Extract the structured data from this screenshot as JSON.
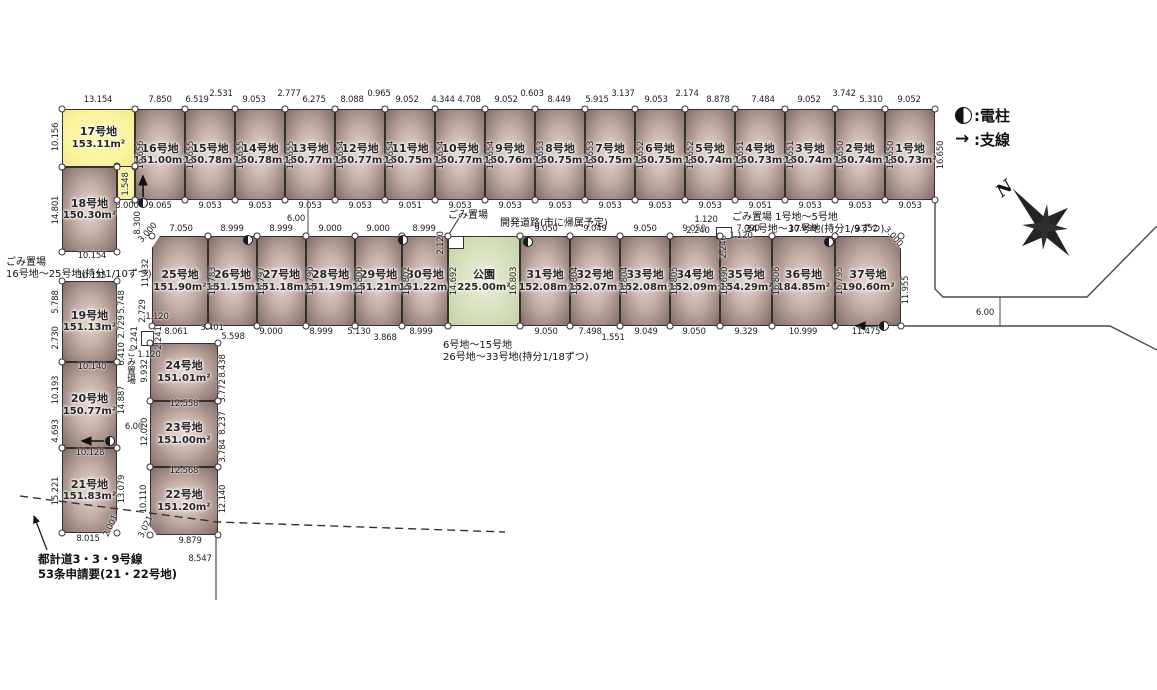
{
  "legend": {
    "pole": ":電柱",
    "wire": ":支線"
  },
  "compass": {
    "north": "N"
  },
  "notes": {
    "garbage_left_1": "ごみ置場",
    "garbage_left_2": "16号地～25号地(持分1/10ずつ)",
    "dev_road": "開発道路(市に帰属予定)",
    "garbage_park": "ごみ置場",
    "garbage_right_1": "ごみ置場  1号地～5号地",
    "garbage_right_2": "34号地～37号地(持分1/9ずつ)",
    "garbage_mid_1": "6号地～15号地",
    "garbage_mid_2": "26号地～33号地(持分1/18ずつ)",
    "garbage_col": "ごみ置場",
    "plan_road_1": "都計道3・3・9号線",
    "plan_road_2": "53条申請要(21・22号地)"
  },
  "lots": [
    {
      "id": "17",
      "name": "17号地",
      "area": "153.11m²",
      "x": 62,
      "y": 109,
      "w": 73,
      "h": 58,
      "type": "highlight"
    },
    {
      "id": "17-strip",
      "x": 117,
      "y": 166,
      "w": 18,
      "h": 34,
      "type": "highlight"
    },
    {
      "id": "16",
      "name": "16号地",
      "area": "151.00m²",
      "x": 135,
      "y": 109,
      "w": 50,
      "h": 91
    },
    {
      "id": "15",
      "name": "15号地",
      "area": "150.78m²",
      "x": 185,
      "y": 109,
      "w": 50,
      "h": 91
    },
    {
      "id": "14",
      "name": "14号地",
      "area": "150.78m²",
      "x": 235,
      "y": 109,
      "w": 50,
      "h": 91
    },
    {
      "id": "13",
      "name": "13号地",
      "area": "150.77m²",
      "x": 285,
      "y": 109,
      "w": 50,
      "h": 91
    },
    {
      "id": "12",
      "name": "12号地",
      "area": "150.77m²",
      "x": 335,
      "y": 109,
      "w": 50,
      "h": 91
    },
    {
      "id": "11",
      "name": "11号地",
      "area": "150.75m²",
      "x": 385,
      "y": 109,
      "w": 50,
      "h": 91
    },
    {
      "id": "10",
      "name": "10号地",
      "area": "150.77m²",
      "x": 435,
      "y": 109,
      "w": 50,
      "h": 91
    },
    {
      "id": "9",
      "name": "9号地",
      "area": "150.76m²",
      "x": 485,
      "y": 109,
      "w": 50,
      "h": 91
    },
    {
      "id": "8",
      "name": "8号地",
      "area": "150.75m²",
      "x": 535,
      "y": 109,
      "w": 50,
      "h": 91
    },
    {
      "id": "7",
      "name": "7号地",
      "area": "150.75m²",
      "x": 585,
      "y": 109,
      "w": 50,
      "h": 91
    },
    {
      "id": "6",
      "name": "6号地",
      "area": "150.75m²",
      "x": 635,
      "y": 109,
      "w": 50,
      "h": 91
    },
    {
      "id": "5",
      "name": "5号地",
      "area": "150.74m²",
      "x": 685,
      "y": 109,
      "w": 50,
      "h": 91
    },
    {
      "id": "4",
      "name": "4号地",
      "area": "150.73m²",
      "x": 735,
      "y": 109,
      "w": 50,
      "h": 91
    },
    {
      "id": "3",
      "name": "3号地",
      "area": "150.74m²",
      "x": 785,
      "y": 109,
      "w": 50,
      "h": 91
    },
    {
      "id": "2",
      "name": "2号地",
      "area": "150.74m²",
      "x": 835,
      "y": 109,
      "w": 50,
      "h": 91
    },
    {
      "id": "1",
      "name": "1号地",
      "area": "150.73m²",
      "x": 885,
      "y": 109,
      "w": 50,
      "h": 91
    },
    {
      "id": "18",
      "name": "18号地",
      "area": "150.30m²",
      "x": 62,
      "y": 167,
      "w": 55,
      "h": 85
    },
    {
      "id": "19",
      "name": "19号地",
      "area": "151.13m²",
      "x": 62,
      "y": 281,
      "w": 55,
      "h": 81
    },
    {
      "id": "20",
      "name": "20号地",
      "area": "150.77m²",
      "x": 62,
      "y": 362,
      "w": 55,
      "h": 86
    },
    {
      "id": "21",
      "name": "21号地",
      "area": "151.83m²",
      "x": 62,
      "y": 448,
      "w": 55,
      "h": 85,
      "clip": "polygon(0 0,100% 0,100% 85%,86% 100%,0 100%)"
    },
    {
      "id": "24",
      "name": "24号地",
      "area": "151.01m²",
      "x": 150,
      "y": 343,
      "w": 68,
      "h": 58
    },
    {
      "id": "23",
      "name": "23号地",
      "area": "151.00m²",
      "x": 150,
      "y": 401,
      "w": 68,
      "h": 66
    },
    {
      "id": "22",
      "name": "22号地",
      "area": "151.20m²",
      "x": 150,
      "y": 467,
      "w": 68,
      "h": 68,
      "clip": "polygon(0 0,100% 0,100% 100%,10% 100%,0 87%)"
    },
    {
      "id": "25",
      "name": "25号地",
      "area": "151.90m²",
      "x": 152,
      "y": 236,
      "w": 56,
      "h": 90,
      "clip": "polygon(14% 0,100% 0,100% 100%,0 100%,0 13%)"
    },
    {
      "id": "26",
      "name": "26号地",
      "area": "151.15m²",
      "x": 208,
      "y": 236,
      "w": 49,
      "h": 90
    },
    {
      "id": "27",
      "name": "27号地",
      "area": "151.18m²",
      "x": 257,
      "y": 236,
      "w": 49,
      "h": 90
    },
    {
      "id": "28",
      "name": "28号地",
      "area": "151.19m²",
      "x": 306,
      "y": 236,
      "w": 49,
      "h": 90
    },
    {
      "id": "29",
      "name": "29号地",
      "area": "151.21m²",
      "x": 355,
      "y": 236,
      "w": 47,
      "h": 90
    },
    {
      "id": "30",
      "name": "30号地",
      "area": "151.22m²",
      "x": 402,
      "y": 236,
      "w": 46,
      "h": 90
    },
    {
      "id": "park",
      "name": "公園",
      "area": "225.00m²",
      "x": 448,
      "y": 236,
      "w": 72,
      "h": 90,
      "type": "park"
    },
    {
      "id": "31",
      "name": "31号地",
      "area": "152.08m²",
      "x": 520,
      "y": 236,
      "w": 50,
      "h": 90
    },
    {
      "id": "32",
      "name": "32号地",
      "area": "152.07m²",
      "x": 570,
      "y": 236,
      "w": 50,
      "h": 90
    },
    {
      "id": "33",
      "name": "33号地",
      "area": "152.08m²",
      "x": 620,
      "y": 236,
      "w": 50,
      "h": 90
    },
    {
      "id": "34",
      "name": "34号地",
      "area": "152.09m²",
      "x": 670,
      "y": 236,
      "w": 50,
      "h": 90
    },
    {
      "id": "35",
      "name": "35号地",
      "area": "154.29m²",
      "x": 720,
      "y": 236,
      "w": 52,
      "h": 90
    },
    {
      "id": "36",
      "name": "36号地",
      "area": "184.85m²",
      "x": 772,
      "y": 236,
      "w": 63,
      "h": 90
    },
    {
      "id": "37",
      "name": "37号地",
      "area": "190.60m²",
      "x": 835,
      "y": 236,
      "w": 66,
      "h": 90,
      "clip": "polygon(0 0,86% 0,100% 14%,100% 100%,0 100%)"
    }
  ],
  "boxes": [
    {
      "x": 448,
      "y": 236,
      "w": 16,
      "h": 13
    },
    {
      "x": 716,
      "y": 227,
      "w": 16,
      "h": 12
    },
    {
      "x": 141,
      "y": 331,
      "w": 13,
      "h": 15
    }
  ],
  "poles": [
    [
      248,
      240
    ],
    [
      403,
      240
    ],
    [
      528,
      242
    ],
    [
      829,
      242
    ],
    [
      884,
      326
    ],
    [
      143,
      203
    ],
    [
      110,
      441
    ]
  ],
  "dims": [
    [
      "13.154",
      98,
      100
    ],
    [
      "7.850",
      160,
      100
    ],
    [
      "6.519",
      197,
      100
    ],
    [
      "2.531",
      221,
      94
    ],
    [
      "9.053",
      254,
      100
    ],
    [
      "2.777",
      289,
      94
    ],
    [
      "6.275",
      314,
      100
    ],
    [
      "8.088",
      352,
      100
    ],
    [
      "0.965",
      379,
      94
    ],
    [
      "9.052",
      407,
      100
    ],
    [
      "4.344",
      443,
      100
    ],
    [
      "4.708",
      469,
      100
    ],
    [
      "9.052",
      506,
      100
    ],
    [
      "0.603",
      532,
      94
    ],
    [
      "8.449",
      559,
      100
    ],
    [
      "5.915",
      597,
      100
    ],
    [
      "3.137",
      623,
      94
    ],
    [
      "9.053",
      656,
      100
    ],
    [
      "2.174",
      687,
      94
    ],
    [
      "8.878",
      718,
      100
    ],
    [
      "7.484",
      763,
      100
    ],
    [
      "9.052",
      809,
      100
    ],
    [
      "3.742",
      844,
      94
    ],
    [
      "5.310",
      871,
      100
    ],
    [
      "9.052",
      909,
      100
    ],
    [
      "10.156",
      56,
      137,
      -90
    ],
    [
      "1.548",
      126,
      184,
      -90
    ],
    [
      "16.656",
      141,
      155,
      -90
    ],
    [
      "16.655",
      191,
      155,
      -90
    ],
    [
      "16.655",
      241,
      155,
      -90
    ],
    [
      "16.655",
      291,
      155,
      -90
    ],
    [
      "16.654",
      341,
      155,
      -90
    ],
    [
      "16.654",
      391,
      155,
      -90
    ],
    [
      "16.654",
      441,
      155,
      -90
    ],
    [
      "16.654",
      491,
      155,
      -90
    ],
    [
      "16.653",
      541,
      155,
      -90
    ],
    [
      "16.653",
      591,
      155,
      -90
    ],
    [
      "16.652",
      641,
      155,
      -90
    ],
    [
      "16.652",
      691,
      155,
      -90
    ],
    [
      "16.651",
      741,
      155,
      -90
    ],
    [
      "16.651",
      791,
      155,
      -90
    ],
    [
      "16.650",
      841,
      155,
      -90
    ],
    [
      "16.650",
      891,
      155,
      -90
    ],
    [
      "16.650",
      941,
      155,
      -90
    ],
    [
      "9.065",
      160,
      206
    ],
    [
      "9.053",
      210,
      206
    ],
    [
      "9.053",
      260,
      206
    ],
    [
      "9.053",
      310,
      206
    ],
    [
      "9.053",
      360,
      206
    ],
    [
      "9.051",
      410,
      206
    ],
    [
      "9.053",
      460,
      206
    ],
    [
      "9.053",
      510,
      206
    ],
    [
      "9.053",
      560,
      206
    ],
    [
      "9.053",
      610,
      206
    ],
    [
      "9.053",
      660,
      206
    ],
    [
      "9.053",
      710,
      206
    ],
    [
      "9.051",
      760,
      206
    ],
    [
      "9.053",
      810,
      206
    ],
    [
      "9.053",
      860,
      206
    ],
    [
      "9.053",
      910,
      206
    ],
    [
      "6.00",
      296,
      219
    ],
    [
      "3.000",
      127,
      206
    ],
    [
      "8.300",
      138,
      223,
      -90
    ],
    [
      "7.050",
      181,
      229
    ],
    [
      "8.999",
      232,
      229
    ],
    [
      "8.999",
      281,
      229
    ],
    [
      "9.000",
      330,
      229
    ],
    [
      "9.000",
      378,
      229
    ],
    [
      "8.999",
      424,
      229
    ],
    [
      "9.050",
      546,
      229
    ],
    [
      "9.049",
      595,
      229
    ],
    [
      "9.050",
      645,
      229
    ],
    [
      "9.050",
      694,
      229
    ],
    [
      "7.090",
      748,
      229
    ],
    [
      "10.999",
      803,
      229
    ],
    [
      "9.352",
      866,
      229
    ],
    [
      "3.000",
      148,
      233,
      -48
    ],
    [
      "3.000",
      893,
      237,
      48
    ],
    [
      "2.120",
      441,
      243,
      -90
    ],
    [
      "1.120",
      706,
      220
    ],
    [
      "2.240",
      698,
      231
    ],
    [
      "1.120",
      741,
      236
    ],
    [
      "2.240",
      724,
      247,
      -90
    ],
    [
      "11.632",
      146,
      273,
      -90
    ],
    [
      "16.783",
      213,
      281,
      -90
    ],
    [
      "16.797",
      262,
      281,
      -90
    ],
    [
      "16.790",
      311,
      281,
      -90
    ],
    [
      "16.800",
      360,
      281,
      -90
    ],
    [
      "16.802",
      407,
      281,
      -90
    ],
    [
      "14.692",
      454,
      281,
      -90
    ],
    [
      "16.803",
      514,
      281,
      -90
    ],
    [
      "16.804",
      575,
      281,
      -90
    ],
    [
      "16.804",
      625,
      281,
      -90
    ],
    [
      "16.805",
      675,
      281,
      -90
    ],
    [
      "15.690",
      725,
      281,
      -90
    ],
    [
      "16.806",
      777,
      281,
      -90
    ],
    [
      "16.795",
      840,
      281,
      -90
    ],
    [
      "11.955",
      906,
      290,
      -90
    ],
    [
      "8.061",
      176,
      332
    ],
    [
      "3.401",
      212,
      328
    ],
    [
      "5.598",
      233,
      337
    ],
    [
      "9.000",
      271,
      332
    ],
    [
      "8.999",
      321,
      332
    ],
    [
      "5.130",
      359,
      332
    ],
    [
      "3.868",
      385,
      338
    ],
    [
      "8.999",
      421,
      332
    ],
    [
      "9.050",
      546,
      332
    ],
    [
      "7.498",
      590,
      332
    ],
    [
      "1.551",
      613,
      338
    ],
    [
      "9.049",
      646,
      332
    ],
    [
      "9.050",
      694,
      332
    ],
    [
      "9.329",
      746,
      332
    ],
    [
      "10.999",
      803,
      332
    ],
    [
      "11.475",
      866,
      332
    ],
    [
      "1.120",
      157,
      317
    ],
    [
      "2.729",
      143,
      311,
      -90
    ],
    [
      "14.801",
      56,
      210,
      -90
    ],
    [
      "10.154",
      92,
      256
    ],
    [
      "10.155",
      92,
      276
    ],
    [
      "5.788",
      56,
      302,
      -90
    ],
    [
      "2.730",
      56,
      338,
      -90
    ],
    [
      "5.748",
      122,
      302,
      -90
    ],
    [
      "2.729",
      122,
      327,
      -90
    ],
    [
      "6.410",
      122,
      354,
      -90
    ],
    [
      "10.140",
      92,
      367
    ],
    [
      "10.193",
      56,
      390,
      -90
    ],
    [
      "4.693",
      56,
      431,
      -90
    ],
    [
      "14.887",
      122,
      400,
      -90
    ],
    [
      "6.00",
      134,
      427
    ],
    [
      "10.128",
      90,
      453
    ],
    [
      "15.221",
      56,
      491,
      -90
    ],
    [
      "13.079",
      122,
      489,
      -90
    ],
    [
      "8.015",
      88,
      539
    ],
    [
      "2.001",
      111,
      526,
      -65
    ],
    [
      "9.932",
      145,
      371,
      -90
    ],
    [
      "8.438",
      223,
      366,
      -90
    ],
    [
      "3.772",
      223,
      391,
      -90
    ],
    [
      "12.558",
      184,
      404
    ],
    [
      "12.020",
      145,
      432,
      -90
    ],
    [
      "8.237",
      223,
      423,
      -90
    ],
    [
      "3.784",
      223,
      451,
      -90
    ],
    [
      "12.568",
      184,
      471
    ],
    [
      "10.110",
      144,
      499,
      -90
    ],
    [
      "12.140",
      223,
      499,
      -90
    ],
    [
      "9.879",
      190,
      541
    ],
    [
      "3.021",
      146,
      527,
      -65
    ],
    [
      "8.547",
      200,
      559
    ],
    [
      "2.241",
      135,
      338,
      -90
    ],
    [
      "2.241",
      159,
      338,
      -90
    ],
    [
      "1.120",
      149,
      355
    ],
    [
      "6.00",
      985,
      313
    ]
  ]
}
